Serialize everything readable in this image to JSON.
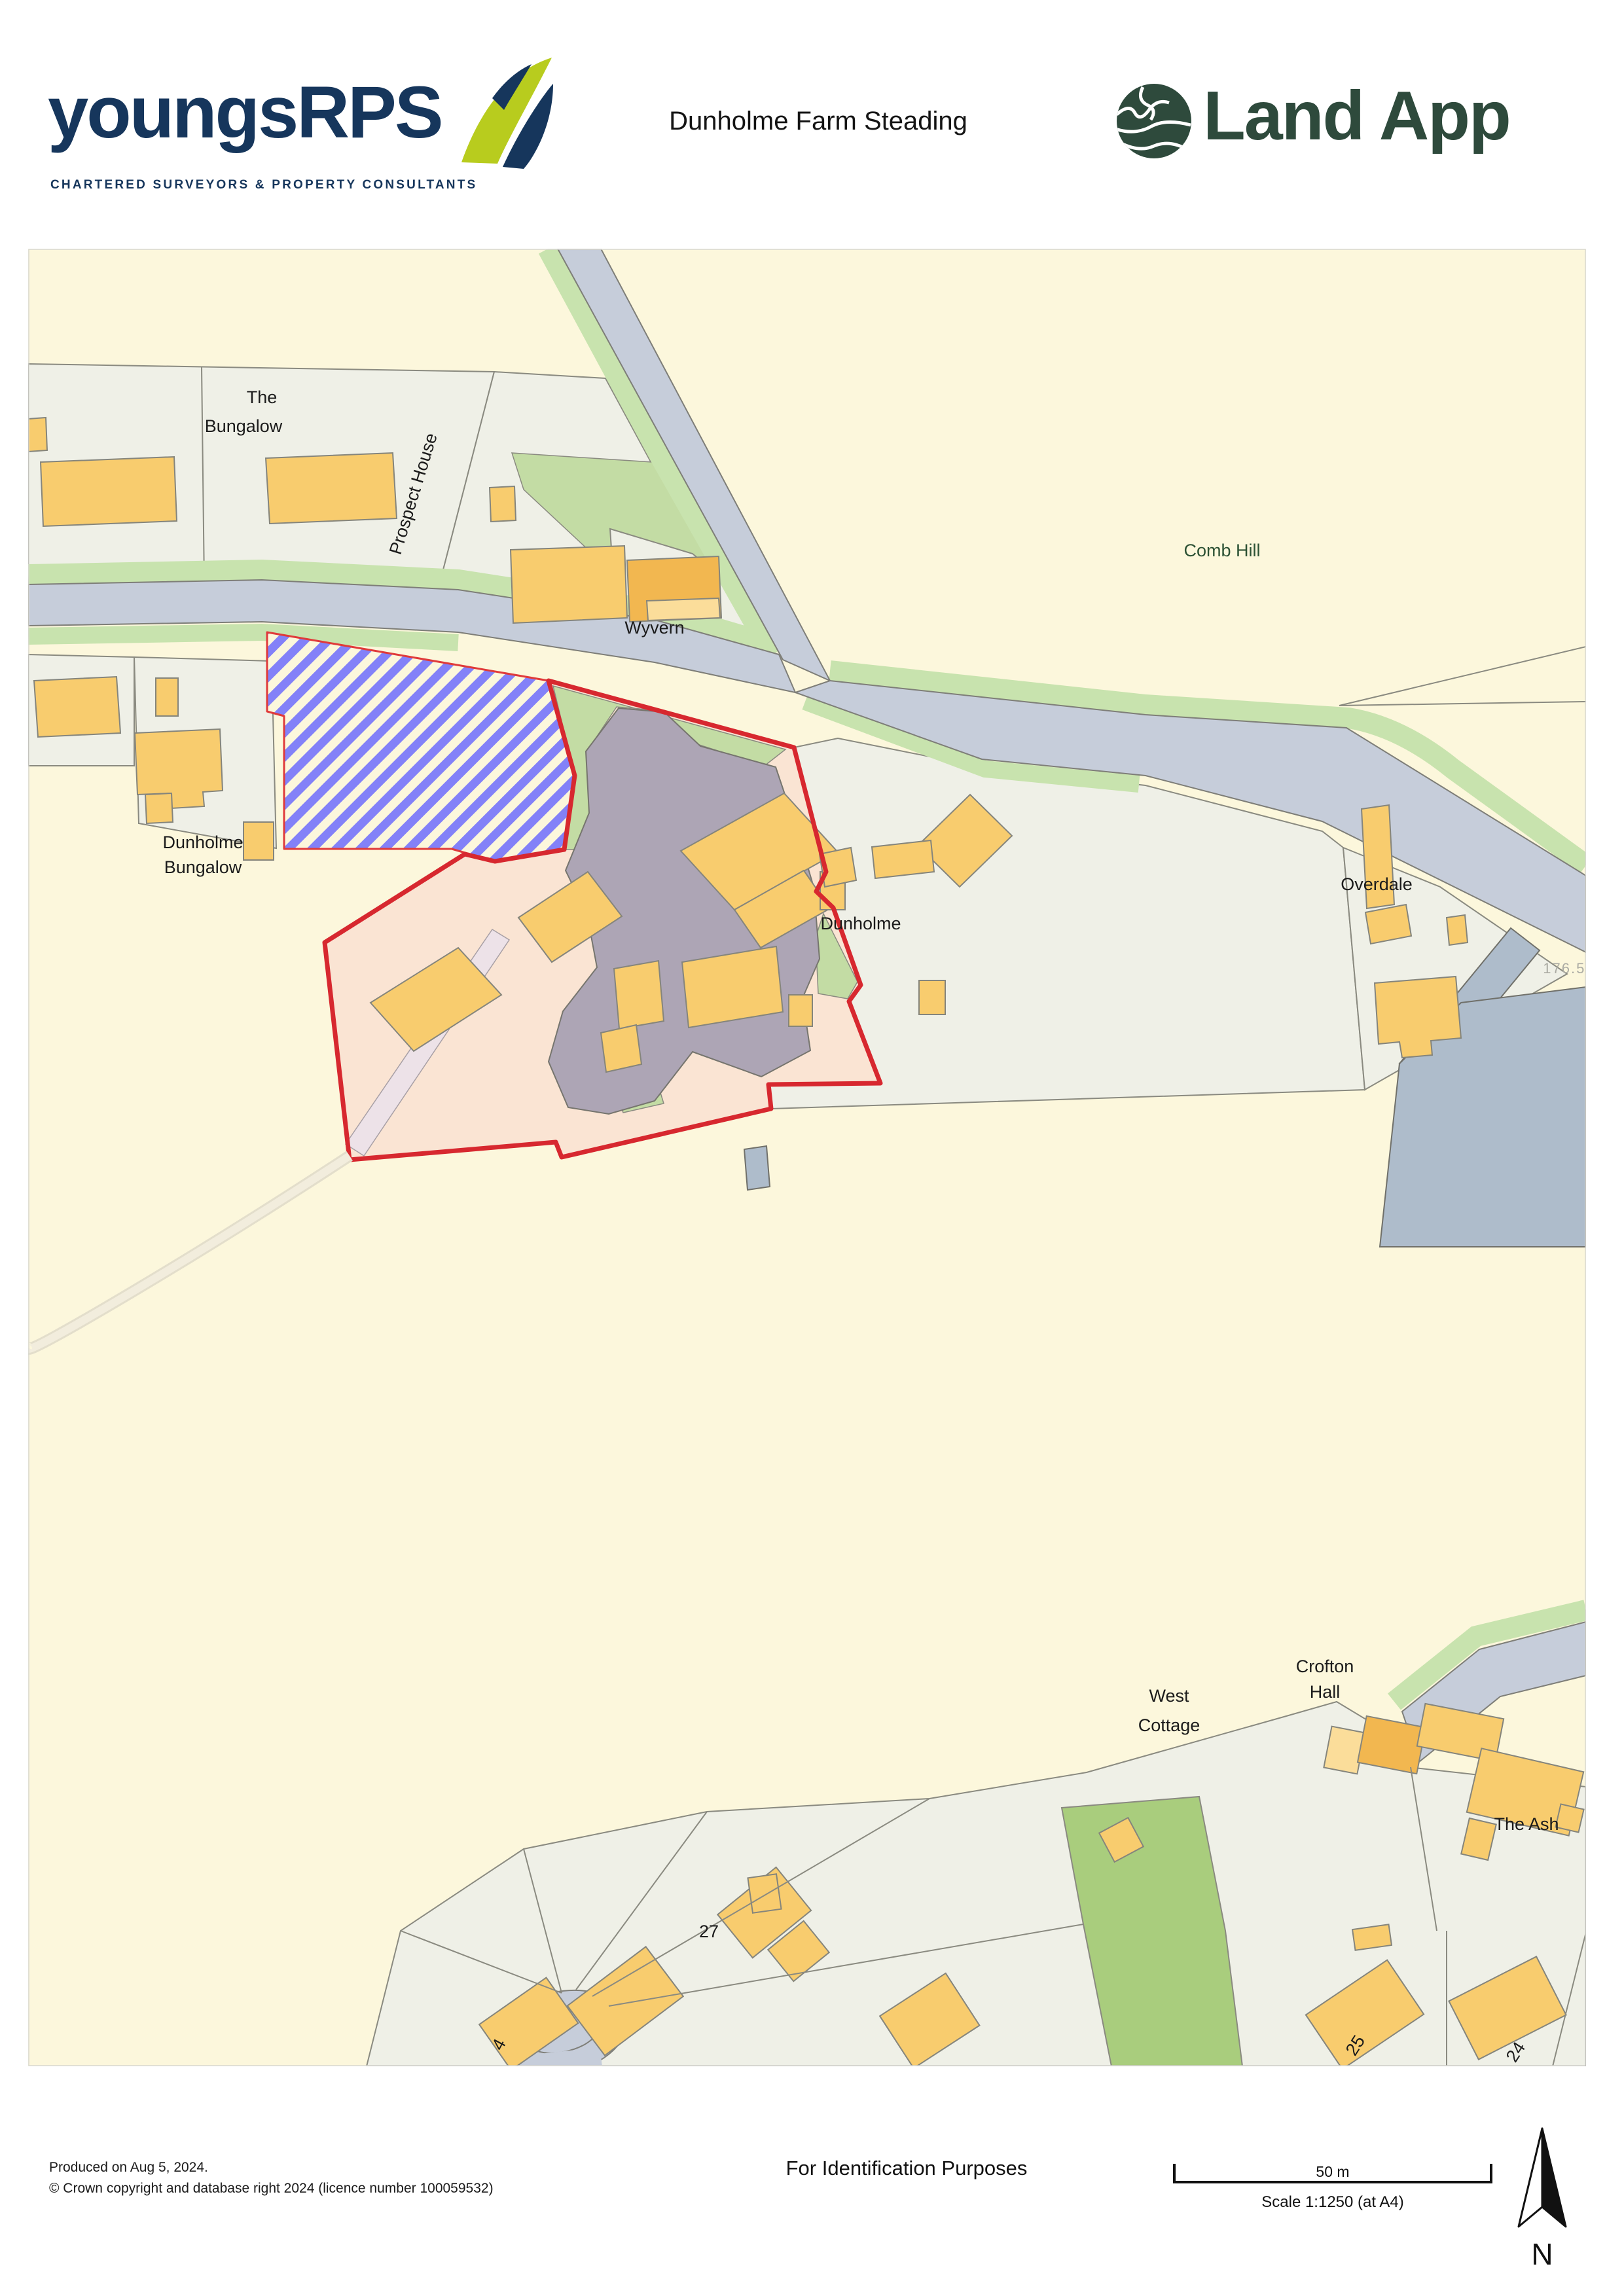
{
  "header": {
    "brand_word": "youngsRPS",
    "brand_tagline": "CHARTERED SURVEYORS & PROPERTY CONSULTANTS",
    "doc_title": "Dunholme Farm Steading",
    "landapp_word": "Land App"
  },
  "map_labels": {
    "the_bungalow_line1": "The",
    "the_bungalow_line2": "Bungalow",
    "prospect_house": "Prospect House",
    "wyvern": "Wyvern",
    "comb_hill": "Comb Hill",
    "dunholme_bungalow_line1": "Dunholme",
    "dunholme_bungalow_line2": "Bungalow",
    "dunholme": "Dunholme",
    "overdale": "Overdale",
    "spot_height": "176.5m",
    "west_cottage_line1": "West",
    "west_cottage_line2": "Cottage",
    "crofton_hall_line1": "Crofton",
    "crofton_hall_line2": "Hall",
    "the_ash": "The Ash",
    "house_27": "27",
    "house_25": "25",
    "house_24": "24",
    "house_4": "4"
  },
  "footer": {
    "produced": "Produced on Aug 5, 2024.",
    "copyright": "© Crown copyright and database right 2024 (licence number 100059532)",
    "purpose": "For Identification Purposes",
    "scale_bar_label": "50 m",
    "scale_text": "Scale 1:1250 (at A4)",
    "north_label": "N"
  },
  "colors": {
    "boundary_red": "#d7282f",
    "proposed_area_hatch_blue": "#8381f8",
    "field_cream": "#fcf7dc",
    "parcel_grey": "#eff0e7",
    "building_orange": "#f8cc6e",
    "road_grey_blue": "#c6cdda",
    "verge_green": "#c8e3ae",
    "farmyard_grey": "#ada5b5",
    "paddock_pink": "#fae4d3",
    "brand_navy": "#16365c",
    "brand_lime": "#b8cc1e",
    "landapp_green": "#2e4a3c"
  }
}
